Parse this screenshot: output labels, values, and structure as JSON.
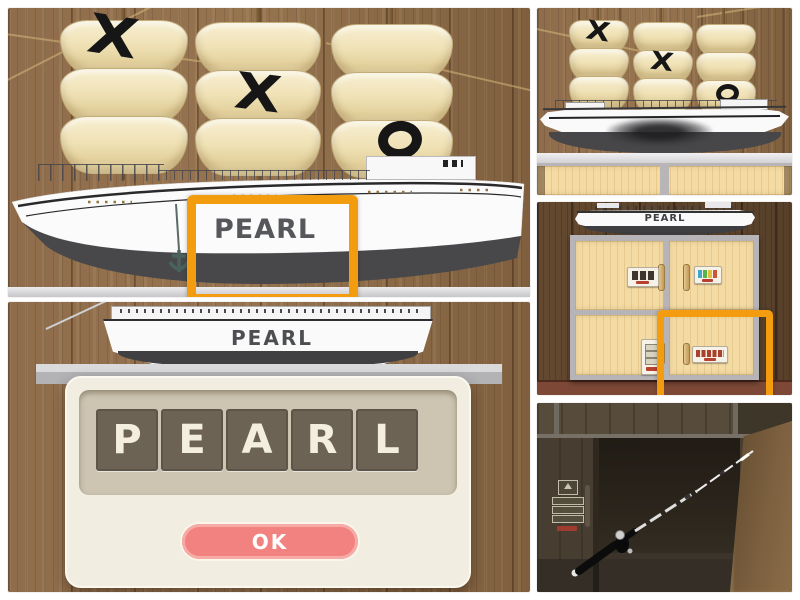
{
  "colors": {
    "highlight_orange": "#F49C10",
    "ok_button_pink": "#F28280",
    "tile_brown": "#6D6355",
    "tile_letter_cream": "#F3EEDD",
    "dialog_cream": "#F2EDE1",
    "sail_cream": "#EFE2BA",
    "wall_wood": "#8D6B4A",
    "cabinet_wood": "#F4DBA4",
    "hull_dark": "#48484A",
    "lock_label_red": "#B8402F"
  },
  "panels": {
    "ship_closeup": {
      "hull_name": "PEARL",
      "marks": [
        {
          "mast": 1,
          "sail": "top",
          "symbol": "X"
        },
        {
          "mast": 2,
          "sail": "middle",
          "symbol": "X"
        },
        {
          "mast": 3,
          "sail": "bottom",
          "symbol": "O"
        }
      ]
    },
    "word_dialog": {
      "ship_name": "PEARL",
      "letters": [
        "P",
        "E",
        "A",
        "R",
        "L"
      ],
      "ok_label": "OK"
    },
    "ship_overview": {
      "marks": [
        {
          "mast": 1,
          "sail": "top",
          "symbol": "X"
        },
        {
          "mast": 2,
          "sail": "middle",
          "symbol": "X"
        },
        {
          "mast": 3,
          "sail": "bottom",
          "symbol": "O"
        }
      ]
    },
    "cabinet": {
      "ship_name": "PEARL"
    },
    "rod_compartment": {
      "contents": "fishing rod"
    }
  }
}
